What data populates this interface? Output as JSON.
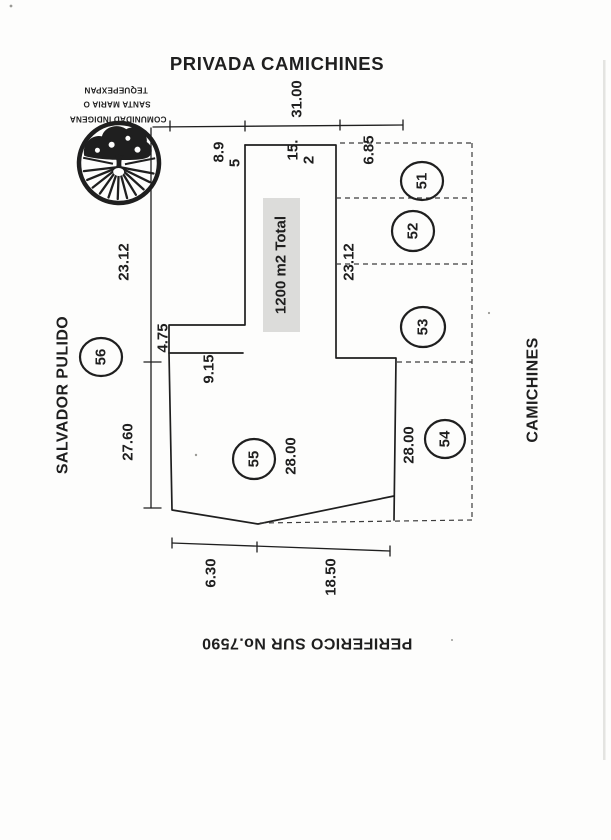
{
  "streets": {
    "top": "PRIVADA CAMICHINES",
    "left": "SALVADOR PULIDO",
    "right": "CAMICHINES",
    "bottom": "PERIFERICO SUR No.7590"
  },
  "stamp": {
    "line1": "COMUNIDAD INDIGENA",
    "line2": "SANTA MARIA O",
    "line3": "TEQUEPEXPAN"
  },
  "parcel": {
    "area_label": "1200 m2 Total"
  },
  "lots": {
    "l51": "51",
    "l52": "52",
    "l53": "53",
    "l54": "54",
    "l55": "55",
    "l56": "56"
  },
  "dims": {
    "top_total": "31.00",
    "top_left_l1": "8.9",
    "top_left_l2": "5",
    "top_mid_l1": "15.",
    "top_mid_l2": "2",
    "top_right": "6.85",
    "left_upper": "23.12",
    "left_lower": "27.60",
    "east": "23.12",
    "step_height": "4.75",
    "step_width": "9.15",
    "lot55_depth": "28.00",
    "lot54_depth": "28.00",
    "bottom_left": "6.30",
    "bottom_right": "18.50"
  },
  "colors": {
    "ink": "#1f1f1f",
    "dashed": "#3c3c3c",
    "highlight": "#dcdcda",
    "paper": "#fdfdfc"
  }
}
